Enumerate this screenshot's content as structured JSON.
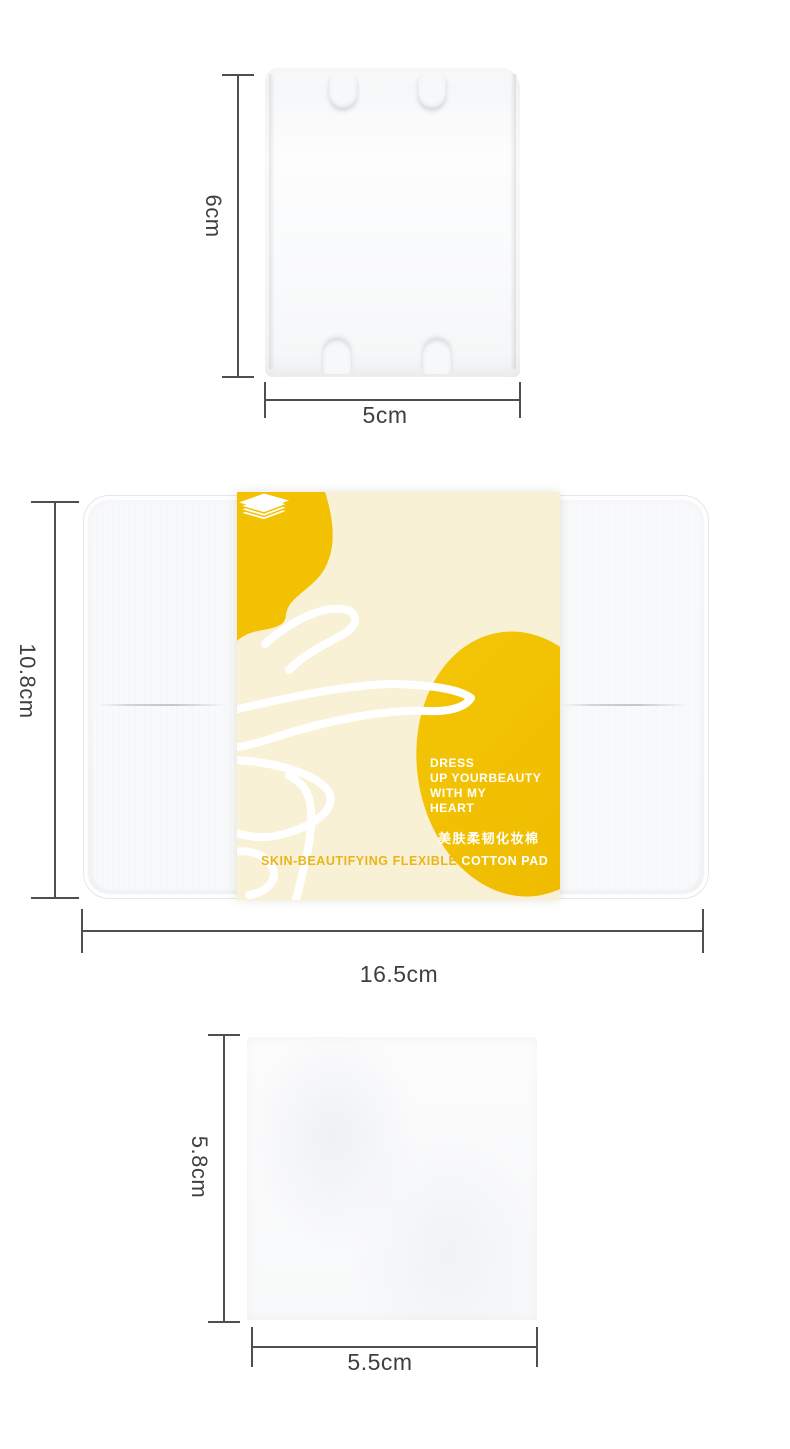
{
  "colors": {
    "accent_yellow": "#F2C101",
    "wrapper_cream": "#F8F1D6",
    "gold_text": "#E9B41C",
    "measure_line": "#4F4F4F",
    "measure_text": "#3F3F3F"
  },
  "icons": {
    "pad_stack": "pad-stack-icon",
    "flower": "flower-outline-art"
  },
  "sections": {
    "pad_rect": {
      "height_label": "6cm",
      "width_label": "5cm"
    },
    "box": {
      "height_label": "10.8cm",
      "width_label": "16.5cm",
      "wrapper": {
        "slogan_line1": "DRESS",
        "slogan_line2": "UP YOURBEAUTY",
        "slogan_line3": "WITH MY",
        "slogan_line4": "HEART",
        "cn_name": "美肤柔韧化妆棉",
        "en_name_left": "SKIN-BEAUTIFYING FLEXIBLE",
        "en_name_right": "COTTON PAD"
      }
    },
    "pad_square": {
      "height_label": "5.8cm",
      "width_label": "5.5cm"
    }
  }
}
